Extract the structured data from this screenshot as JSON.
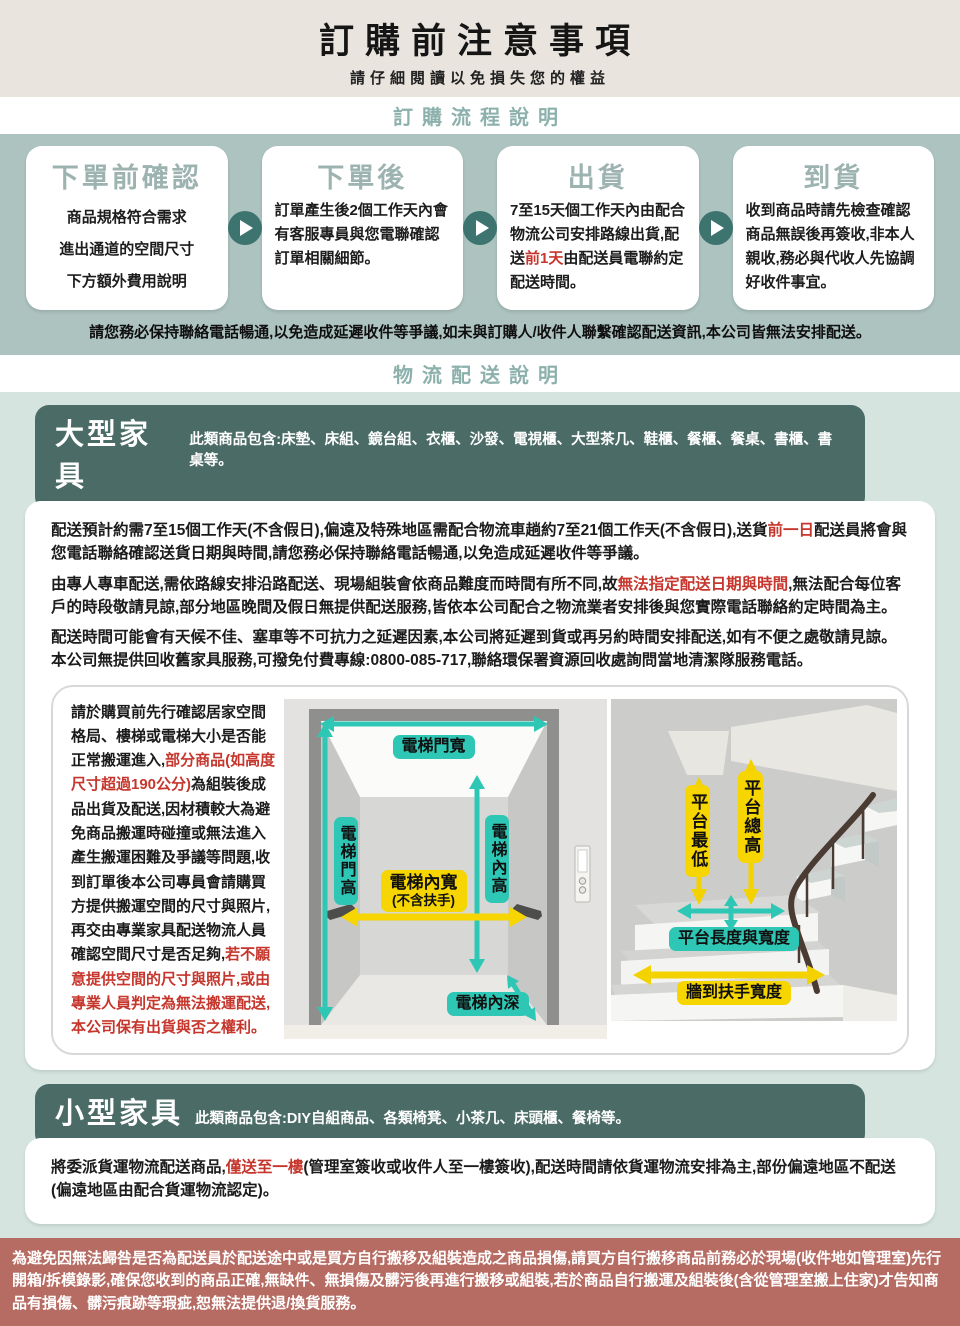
{
  "page": {
    "title": "訂購前注意事項",
    "subtitle": "請仔細閱讀以免損失您的權益"
  },
  "sections": {
    "process_label": "訂購流程說明",
    "logistics_label": "物流配送說明"
  },
  "steps": [
    {
      "title": "下單前確認",
      "lines": [
        "商品規格符合需求",
        "進出通道的空間尺寸",
        "下方額外費用說明"
      ]
    },
    {
      "title": "下單後",
      "body": "訂單產生後2個工作天內會有客服專員與您電聯確認訂單相關細節。"
    },
    {
      "title": "出貨",
      "body_pre": "7至15天個工作天內由配合物流公司安排路線出貨,配送",
      "body_red": "前1天",
      "body_post": "由配送員電聯約定配送時間。"
    },
    {
      "title": "到貨",
      "body": "收到商品時請先檢查確認商品無誤後再簽收,非本人親收,務必與代收人先協調好收件事宜。"
    }
  ],
  "process_warning": "請您務必保持聯絡電話暢通,以免造成延遲收件等爭議,如未與訂購人/收件人聯繫確認配送資訊,本公司皆無法安排配送。",
  "large_furniture": {
    "title": "大型家具",
    "includes": "此類商品包含:床墊、床組、鏡台組、衣櫃、沙發、電視櫃、大型茶几、鞋櫃、餐櫃、餐桌、書櫃、書桌等。",
    "p1": {
      "pre": "配送預計約需7至15個工作天(不含假日),偏遠及特殊地區需配合物流車趟約7至21個工作天(不含假日),送貨",
      "red": "前一日",
      "post": "配送員將會與您電話聯絡確認送貨日期與時間,請您務必保持聯絡電話暢通,以免造成延遲收件等爭議。"
    },
    "p2": {
      "pre": "由專人專車配送,需依路線安排沿路配送、現場組裝會依商品難度而時間有所不同,故",
      "red": "無法指定配送日期與時間",
      "post": ",無法配合每位客戶的時段敬請見諒,部分地區晚間及假日無提供配送服務,皆依本公司配合之物流業者安排後與您實際電話聯絡約定時間為主。"
    },
    "p3": "配送時間可能會有天候不佳、塞車等不可抗力之延遲因素,本公司將延遲到貨或再另約時間安排配送,如有不便之處敬請見諒。本公司無提供回收舊家具服務,可撥免付費專線:0800-085-717,聯絡環保署資源回收處詢問當地清潔隊服務電話。",
    "space_note": {
      "pre": "請於購買前先行確認居家空間格局、樓梯或電梯大小是否能正常搬運進入,",
      "red1": "部分商品(如高度尺寸超過190公分)",
      "mid": "為組裝後成品出貨及配送,因材積較大為避免商品搬運時碰撞或無法進入產生搬運困難及爭議等問題,收到訂單後本公司專員會請購買方提供搬運空間的尺寸與照片,再交由專業家具配送物流人員確認空間尺寸是否足夠,",
      "red2": "若不願意提供空間的尺寸與照片,或由專業人員判定為無法搬運配送,本公司保有出貨與否之權利。"
    }
  },
  "elevator_labels": {
    "door_width": "電梯門寬",
    "door_height": "電梯門高",
    "inner_height": "電梯內高",
    "inner_width_line1": "電梯內寬",
    "inner_width_line2": "(不含扶手)",
    "inner_depth": "電梯內深"
  },
  "stair_labels": {
    "platform_min": "平台最低",
    "platform_total": "平台總高",
    "platform_length_width": "平台長度與寬度",
    "wall_to_rail": "牆到扶手寬度"
  },
  "small_furniture": {
    "title": "小型家具",
    "includes": "此類商品包含:DIY自組商品、各類椅凳、小茶几、床頭櫃、餐椅等。",
    "p": {
      "pre": "將委派貨運物流配送商品,",
      "red": "僅送至一樓",
      "post": "(管理室簽收或收件人至一樓簽收),配送時間請依貨運物流安排為主,部份偏遠地區不配送(偏遠地區由配合貨運物流認定)。"
    }
  },
  "footer_note": "為避免因無法歸咎是否為配送員於配送途中或是買方自行搬移及組裝造成之商品損傷,請買方自行搬移商品前務必於現場(收件地如管理室)先行開箱/拆模錄影,確保您收到的商品正確,無缺件、無損傷及髒污後再進行搬移或組裝,若於商品自行搬運及組裝後(含從管理室搬上住家)才告知商品有損傷、髒污痕跡等瑕疵,恕無法提供退/換貨服務。",
  "colors": {
    "accent_teal": "#2ec7b5",
    "accent_yellow": "#f6d500",
    "alert_red": "#c6362c",
    "sage_band": "#adc3bf",
    "mint_band": "#d5e4df",
    "header_teal": "#4b6c66",
    "footer_red": "#b66c63",
    "hero_beige": "#e9e4de"
  }
}
